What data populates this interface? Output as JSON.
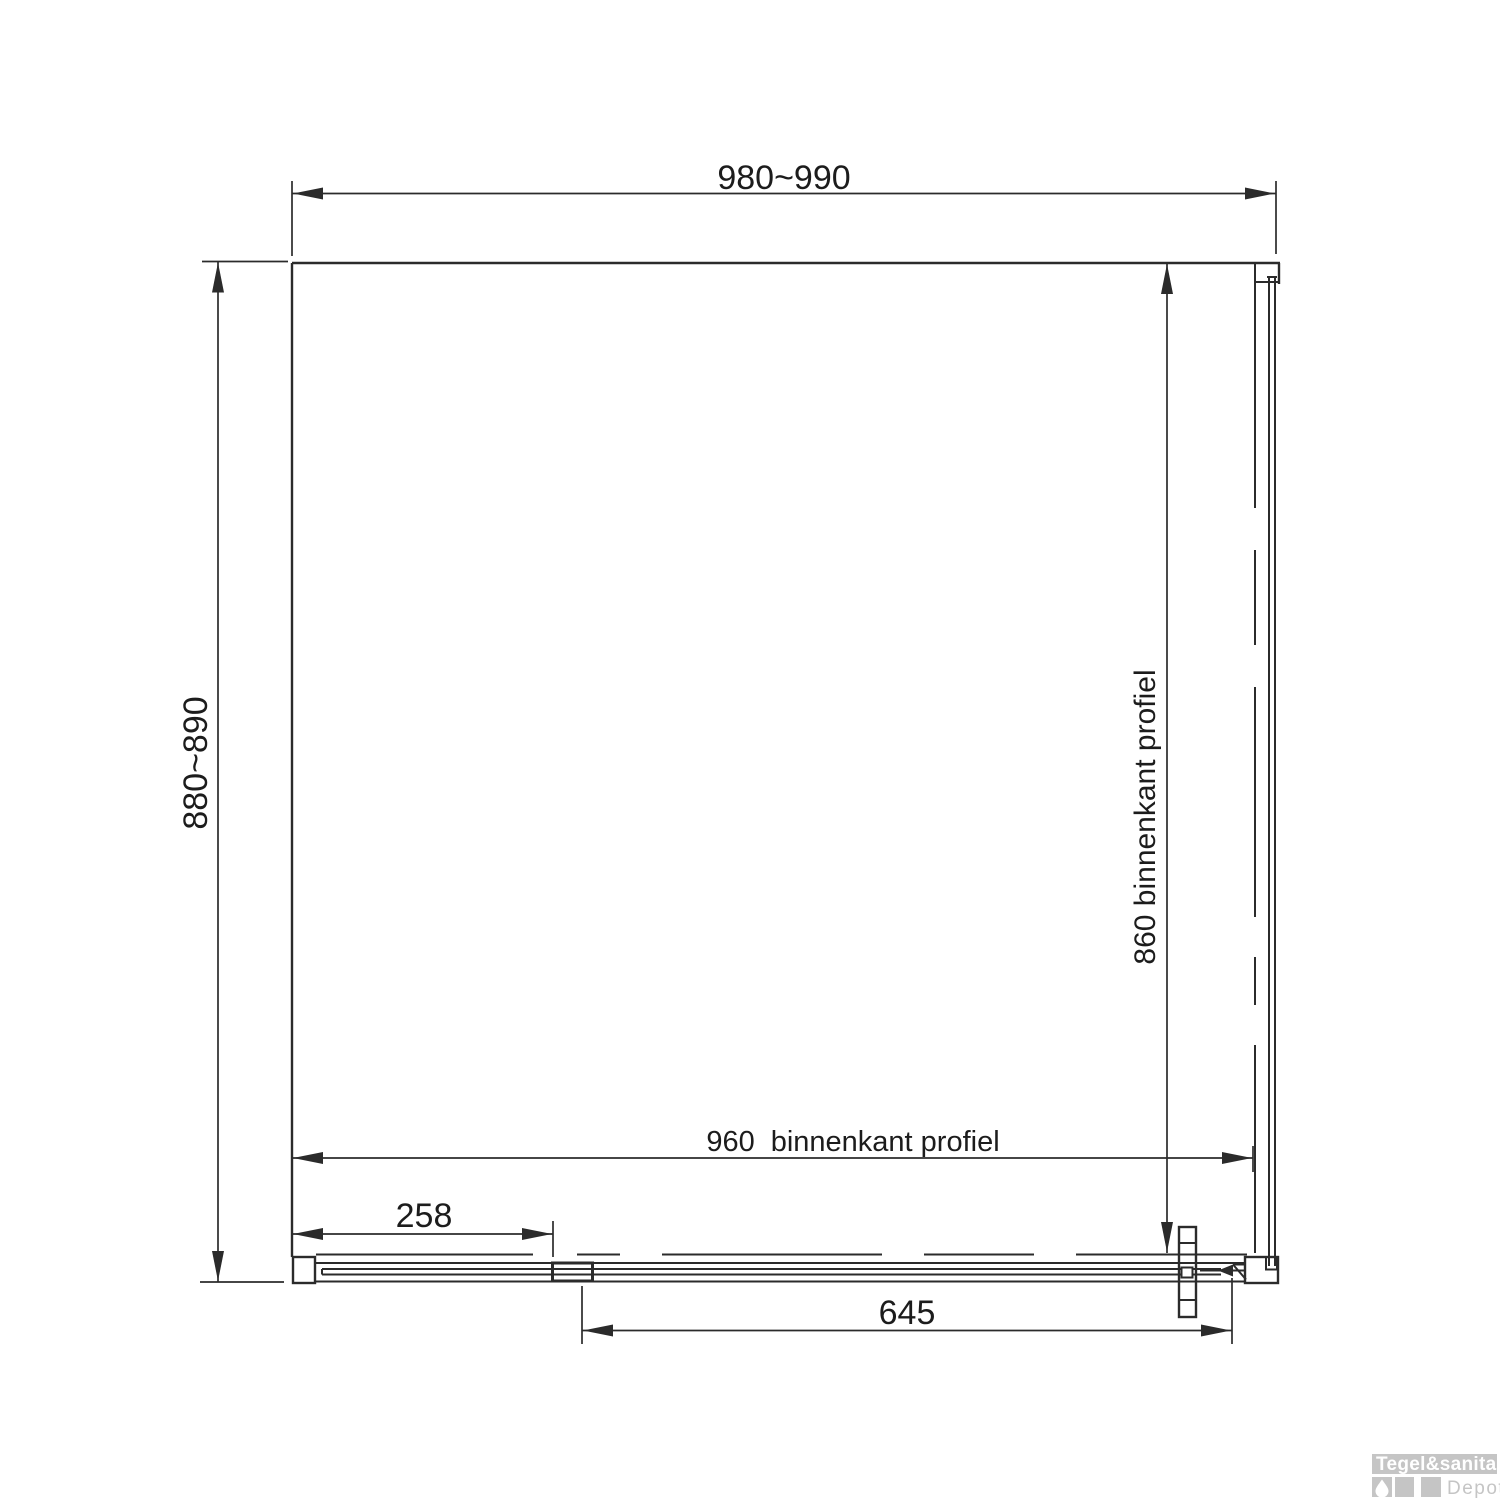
{
  "dimensions": {
    "outer_width": "980~990",
    "outer_depth": "880~890",
    "inner_height_label": "860 binnenkant profiel",
    "inner_width_value": "960",
    "inner_width_label": "binnenkant profiel",
    "left_offset": "258",
    "door_width": "645"
  },
  "logo": {
    "brand": "Tegel&sanitair",
    "subtitle": "Depot"
  },
  "colors": {
    "line": "#2b2b2b",
    "text": "#1c1c1c",
    "logo_gray": "#c5c5c5",
    "logo_white": "#ffffff"
  }
}
